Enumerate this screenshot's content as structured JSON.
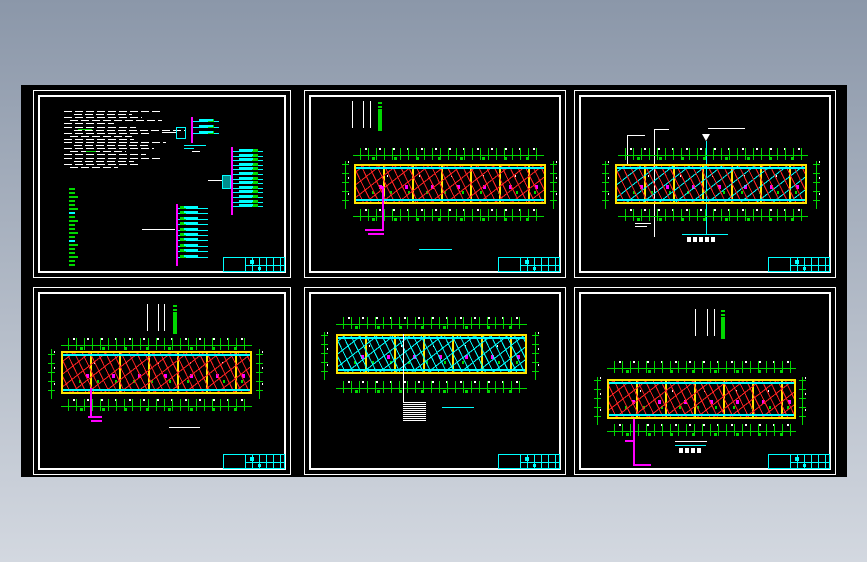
{
  "page": {
    "bg_top": "#8b97a9",
    "bg_bottom": "#d3d8e0",
    "canvas_bg": "#000000"
  },
  "colors": {
    "dim": "#00d800",
    "wall": "#ffe400",
    "cyan": "#00ffff",
    "mag": "#ff00ff",
    "wred": "#ff2222",
    "bgtop": "#8b97a9",
    "bgbot": "#d3d8e0",
    "canvas": "#000000"
  },
  "sheets": [
    {
      "type": "general-notes-and-riser-diagrams",
      "notes": {
        "line_widths": [
          96,
          58,
          78,
          92,
          50,
          72,
          112,
          88,
          62,
          70,
          102,
          74,
          90,
          56,
          82,
          96,
          60,
          76,
          48
        ]
      },
      "legend": {
        "items": 20
      },
      "risers": {
        "top": {
          "rows": 3
        },
        "right": {
          "rows": 13
        },
        "bottom": {
          "rows": 10
        }
      }
    },
    {
      "type": "floor-plan",
      "wiring": "red",
      "has_feeder": true,
      "marker_bars": 3
    },
    {
      "type": "floor-plan",
      "wiring": "mixed",
      "has_leader_lines": true
    },
    {
      "type": "floor-plan",
      "wiring": "red",
      "has_feeder": true,
      "marker_bars": 3
    },
    {
      "type": "floor-plan",
      "wiring": "cyan",
      "stair_hatch": {
        "lines": 10
      }
    },
    {
      "type": "floor-plan",
      "wiring": "red",
      "has_feeder": true,
      "marker_bars": 3
    }
  ]
}
